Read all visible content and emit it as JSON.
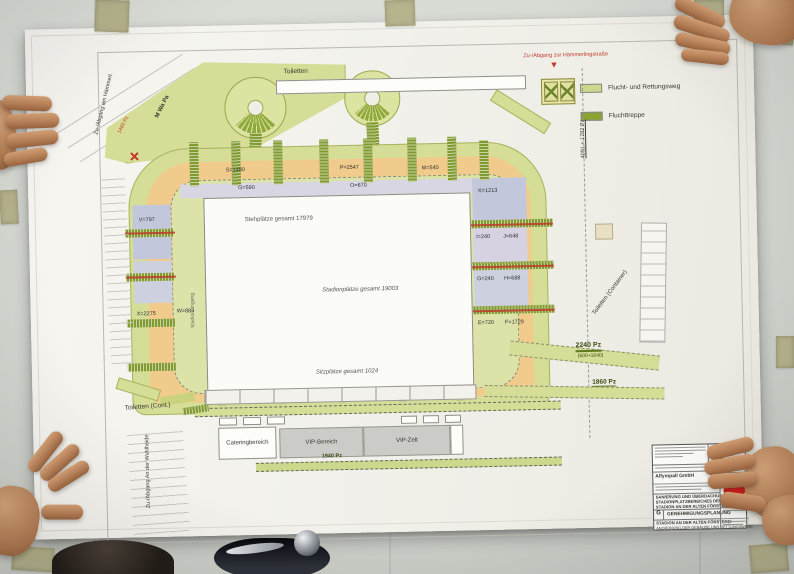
{
  "legend": {
    "items": [
      {
        "label": "Flucht- und Rettungsweg",
        "color": "#ccd88c"
      },
      {
        "label": "Fluchttreppe",
        "color": "#8aa433"
      }
    ]
  },
  "plan": {
    "toiletten_top": "Toiletten",
    "toiletten_cont": "Toiletten (Cont.)",
    "toiletten_container": "Toiletten (Container)",
    "m_wa_pa": "M Wa Pa",
    "pz_1460": "1460 Pz",
    "access_top_right": "Zu-/Abgang zur Hämmerlingstraße",
    "access_top_left": "Zu-/Abgang am Hämmerl.",
    "access_bottom_left": "Zu-/Abgang An der Wuhlheide",
    "dim_right": "4091 + 1782 Pz",
    "route_2240": "2240 Pz",
    "route_2240_detail": "(600+1640)",
    "route_1860": "1860 Pz",
    "route_1940": "1940 Pz",
    "stadionumgang": "Stadionumgang",
    "pitch": {
      "standing": "Stehplätze gesamt 17979",
      "total": "Stadionplätze gesamt 19003",
      "seats": "Sitzplätze gesamt 1024"
    },
    "buildings": {
      "catering": "Cateringbereich",
      "vip_bereich": "VIP-Bereich",
      "vip_zelt": "VIP-Zelt"
    },
    "sections": {
      "top": [
        "S=1480",
        "P=2547",
        "M=540",
        "G=590",
        "O=670"
      ],
      "left": [
        "V=797",
        "X=2275",
        "W=883"
      ],
      "right": [
        "K=1213",
        "I=240",
        "J=648",
        "G=240",
        "H=688",
        "E=720",
        "F=1729"
      ]
    }
  },
  "icons": {
    "entrance_marker": "▼"
  },
  "title_block": {
    "company": "Alfympall GmbH",
    "project_line1": "SANIERUNG UND ÜBERDACHUNG DES",
    "project_line2": "STADIONPLATZBEREICHES DES",
    "project_line3": "STADION AN DER ALTEN FÖRSTEREI",
    "phase_letter": "G",
    "phase": "GENEHMIGUNGSPLANUNG",
    "object_line1": "STADION AN DER ALTEN FÖRSTEREI",
    "object_line2": "ANORDNUNG DER GEBÄUDE UND RETTUNGSWEGE",
    "logo_text": "Union"
  },
  "colors": {
    "rescue_route_green": "#ccd88c",
    "escape_stair_green": "#8aa433",
    "terrace_orange": "#f1cb8b",
    "block_blue": "#c3c7db",
    "marker_red": "#c0392b"
  }
}
